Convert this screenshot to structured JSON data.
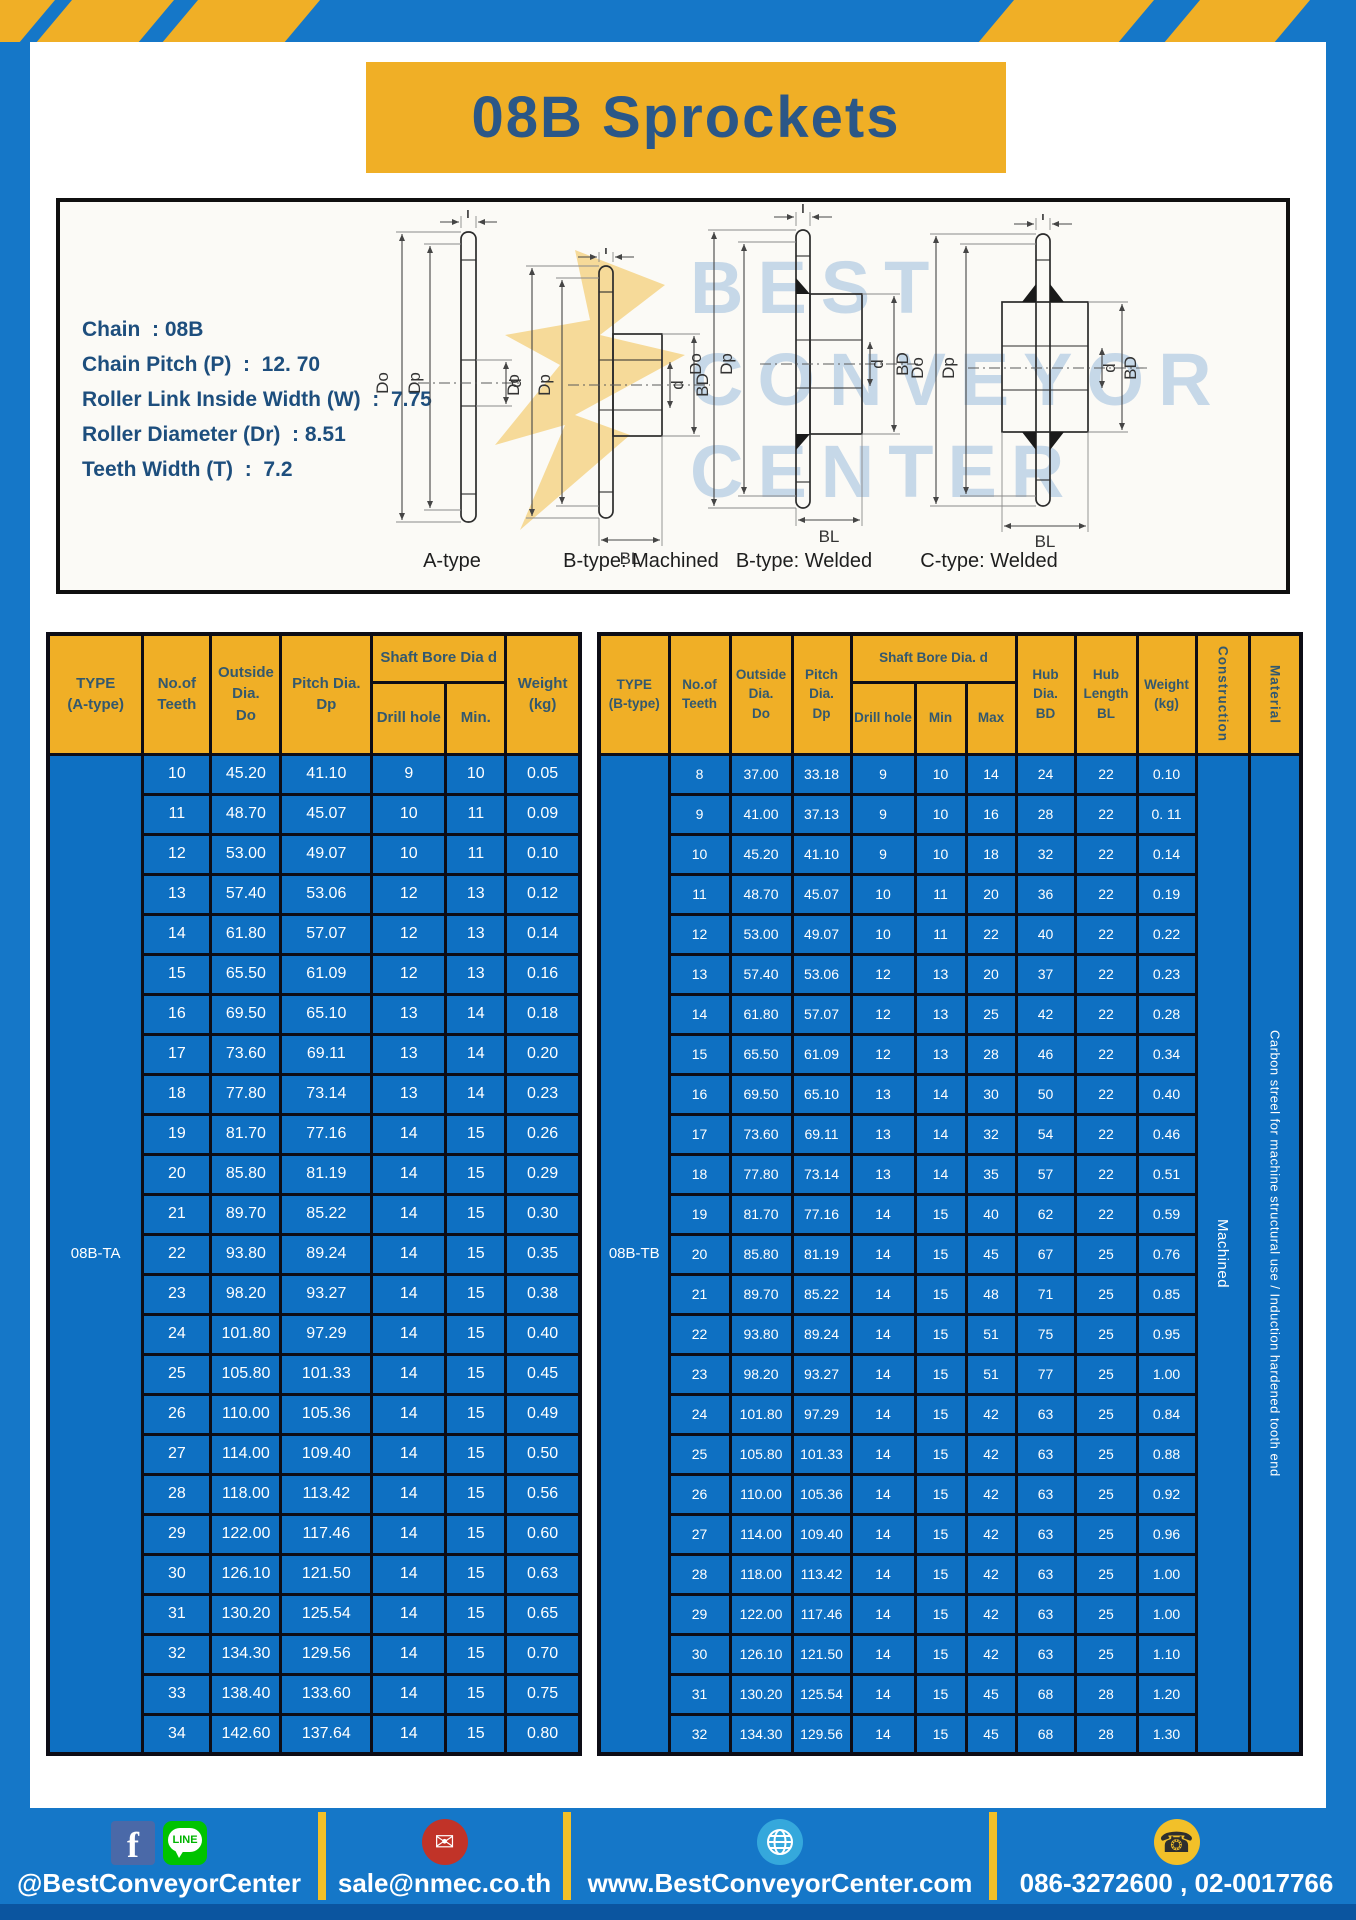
{
  "page": {
    "title": "08B Sprockets"
  },
  "colors": {
    "frame_blue": "#1577c8",
    "cell_blue": "#0e70c2",
    "accent_yellow": "#f0af26",
    "title_text": "#2b5787",
    "header_text": "#33586e",
    "bottom_strip": "#0b55a0",
    "facebook": "#4a69a8",
    "line_green": "#00c300",
    "mail_red": "#c13328",
    "globe_blue": "#35a8dc",
    "phone_yellow": "#f2c029"
  },
  "specs": {
    "lines": [
      "Chain  : 08B",
      "Chain Pitch (P)  :  12. 70",
      "Roller Link Inside Width (W)  :  7.75",
      "Roller Diameter (Dr)  : 8.51",
      "Teeth Width (T)  :  7.2"
    ]
  },
  "diagram": {
    "captions": [
      "A-type",
      "B-type: Machined",
      "B-type: Welded",
      "C-type: Welded"
    ],
    "dims": {
      "t": "T",
      "do": "Do",
      "dp": "Dp",
      "d": "d",
      "bd": "BD",
      "bl": "BL"
    },
    "watermark": [
      "BEST",
      "CONVEYOR",
      "CENTER"
    ]
  },
  "table_a": {
    "type_label": "08B-TA",
    "headers": {
      "type": "TYPE\n(A-type)",
      "teeth": "No.of\nTeeth",
      "outside": "Outside\nDia.\nDo",
      "pitch": "Pitch Dia.\nDp",
      "shaft": "Shaft Bore Dia d",
      "drill": "Drill hole",
      "min": "Min.",
      "weight": "Weight\n(kg)"
    },
    "rows": [
      [
        "10",
        "45.20",
        "41.10",
        "9",
        "10",
        "0.05"
      ],
      [
        "11",
        "48.70",
        "45.07",
        "10",
        "11",
        "0.09"
      ],
      [
        "12",
        "53.00",
        "49.07",
        "10",
        "11",
        "0.10"
      ],
      [
        "13",
        "57.40",
        "53.06",
        "12",
        "13",
        "0.12"
      ],
      [
        "14",
        "61.80",
        "57.07",
        "12",
        "13",
        "0.14"
      ],
      [
        "15",
        "65.50",
        "61.09",
        "12",
        "13",
        "0.16"
      ],
      [
        "16",
        "69.50",
        "65.10",
        "13",
        "14",
        "0.18"
      ],
      [
        "17",
        "73.60",
        "69.11",
        "13",
        "14",
        "0.20"
      ],
      [
        "18",
        "77.80",
        "73.14",
        "13",
        "14",
        "0.23"
      ],
      [
        "19",
        "81.70",
        "77.16",
        "14",
        "15",
        "0.26"
      ],
      [
        "20",
        "85.80",
        "81.19",
        "14",
        "15",
        "0.29"
      ],
      [
        "21",
        "89.70",
        "85.22",
        "14",
        "15",
        "0.30"
      ],
      [
        "22",
        "93.80",
        "89.24",
        "14",
        "15",
        "0.35"
      ],
      [
        "23",
        "98.20",
        "93.27",
        "14",
        "15",
        "0.38"
      ],
      [
        "24",
        "101.80",
        "97.29",
        "14",
        "15",
        "0.40"
      ],
      [
        "25",
        "105.80",
        "101.33",
        "14",
        "15",
        "0.45"
      ],
      [
        "26",
        "110.00",
        "105.36",
        "14",
        "15",
        "0.49"
      ],
      [
        "27",
        "114.00",
        "109.40",
        "14",
        "15",
        "0.50"
      ],
      [
        "28",
        "118.00",
        "113.42",
        "14",
        "15",
        "0.56"
      ],
      [
        "29",
        "122.00",
        "117.46",
        "14",
        "15",
        "0.60"
      ],
      [
        "30",
        "126.10",
        "121.50",
        "14",
        "15",
        "0.63"
      ],
      [
        "31",
        "130.20",
        "125.54",
        "14",
        "15",
        "0.65"
      ],
      [
        "32",
        "134.30",
        "129.56",
        "14",
        "15",
        "0.70"
      ],
      [
        "33",
        "138.40",
        "133.60",
        "14",
        "15",
        "0.75"
      ],
      [
        "34",
        "142.60",
        "137.64",
        "14",
        "15",
        "0.80"
      ]
    ]
  },
  "table_b": {
    "type_label": "08B-TB",
    "construction": "Machined",
    "material": "Carbon streel for machine structural use / Induction hardened tooth end",
    "headers": {
      "type": "TYPE\n(B-type)",
      "teeth": "No.of\nTeeth",
      "outside": "Outside\nDia.\nDo",
      "pitch": "Pitch\nDia.\nDp",
      "shaft": "Shaft Bore Dia.  d",
      "drill": "Drill hole",
      "min": "Min",
      "max": "Max",
      "hub_dia": "Hub\nDia.\nBD",
      "hub_len": "Hub\nLength\nBL",
      "weight": "Weight\n(kg)",
      "construction": "Construction",
      "material": "Material"
    },
    "rows": [
      [
        "8",
        "37.00",
        "33.18",
        "9",
        "10",
        "14",
        "24",
        "22",
        "0.10"
      ],
      [
        "9",
        "41.00",
        "37.13",
        "9",
        "10",
        "16",
        "28",
        "22",
        "0. 11"
      ],
      [
        "10",
        "45.20",
        "41.10",
        "9",
        "10",
        "18",
        "32",
        "22",
        "0.14"
      ],
      [
        "11",
        "48.70",
        "45.07",
        "10",
        "11",
        "20",
        "36",
        "22",
        "0.19"
      ],
      [
        "12",
        "53.00",
        "49.07",
        "10",
        "11",
        "22",
        "40",
        "22",
        "0.22"
      ],
      [
        "13",
        "57.40",
        "53.06",
        "12",
        "13",
        "20",
        "37",
        "22",
        "0.23"
      ],
      [
        "14",
        "61.80",
        "57.07",
        "12",
        "13",
        "25",
        "42",
        "22",
        "0.28"
      ],
      [
        "15",
        "65.50",
        "61.09",
        "12",
        "13",
        "28",
        "46",
        "22",
        "0.34"
      ],
      [
        "16",
        "69.50",
        "65.10",
        "13",
        "14",
        "30",
        "50",
        "22",
        "0.40"
      ],
      [
        "17",
        "73.60",
        "69.11",
        "13",
        "14",
        "32",
        "54",
        "22",
        "0.46"
      ],
      [
        "18",
        "77.80",
        "73.14",
        "13",
        "14",
        "35",
        "57",
        "22",
        "0.51"
      ],
      [
        "19",
        "81.70",
        "77.16",
        "14",
        "15",
        "40",
        "62",
        "22",
        "0.59"
      ],
      [
        "20",
        "85.80",
        "81.19",
        "14",
        "15",
        "45",
        "67",
        "25",
        "0.76"
      ],
      [
        "21",
        "89.70",
        "85.22",
        "14",
        "15",
        "48",
        "71",
        "25",
        "0.85"
      ],
      [
        "22",
        "93.80",
        "89.24",
        "14",
        "15",
        "51",
        "75",
        "25",
        "0.95"
      ],
      [
        "23",
        "98.20",
        "93.27",
        "14",
        "15",
        "51",
        "77",
        "25",
        "1.00"
      ],
      [
        "24",
        "101.80",
        "97.29",
        "14",
        "15",
        "42",
        "63",
        "25",
        "0.84"
      ],
      [
        "25",
        "105.80",
        "101.33",
        "14",
        "15",
        "42",
        "63",
        "25",
        "0.88"
      ],
      [
        "26",
        "110.00",
        "105.36",
        "14",
        "15",
        "42",
        "63",
        "25",
        "0.92"
      ],
      [
        "27",
        "114.00",
        "109.40",
        "14",
        "15",
        "42",
        "63",
        "25",
        "0.96"
      ],
      [
        "28",
        "118.00",
        "113.42",
        "14",
        "15",
        "42",
        "63",
        "25",
        "1.00"
      ],
      [
        "29",
        "122.00",
        "117.46",
        "14",
        "15",
        "42",
        "63",
        "25",
        "1.00"
      ],
      [
        "30",
        "126.10",
        "121.50",
        "14",
        "15",
        "42",
        "63",
        "25",
        "1.10"
      ],
      [
        "31",
        "130.20",
        "125.54",
        "14",
        "15",
        "45",
        "68",
        "28",
        "1.20"
      ],
      [
        "32",
        "134.30",
        "129.56",
        "14",
        "15",
        "45",
        "68",
        "28",
        "1.30"
      ]
    ]
  },
  "footer": {
    "social_handle": "@BestConveyorCenter",
    "line_label": "LINE",
    "facebook_letter": "f",
    "email": "sale@nmec.co.th",
    "website": "www.BestConveyorCenter.com",
    "phone": "086-3272600 , 02-0017766"
  }
}
